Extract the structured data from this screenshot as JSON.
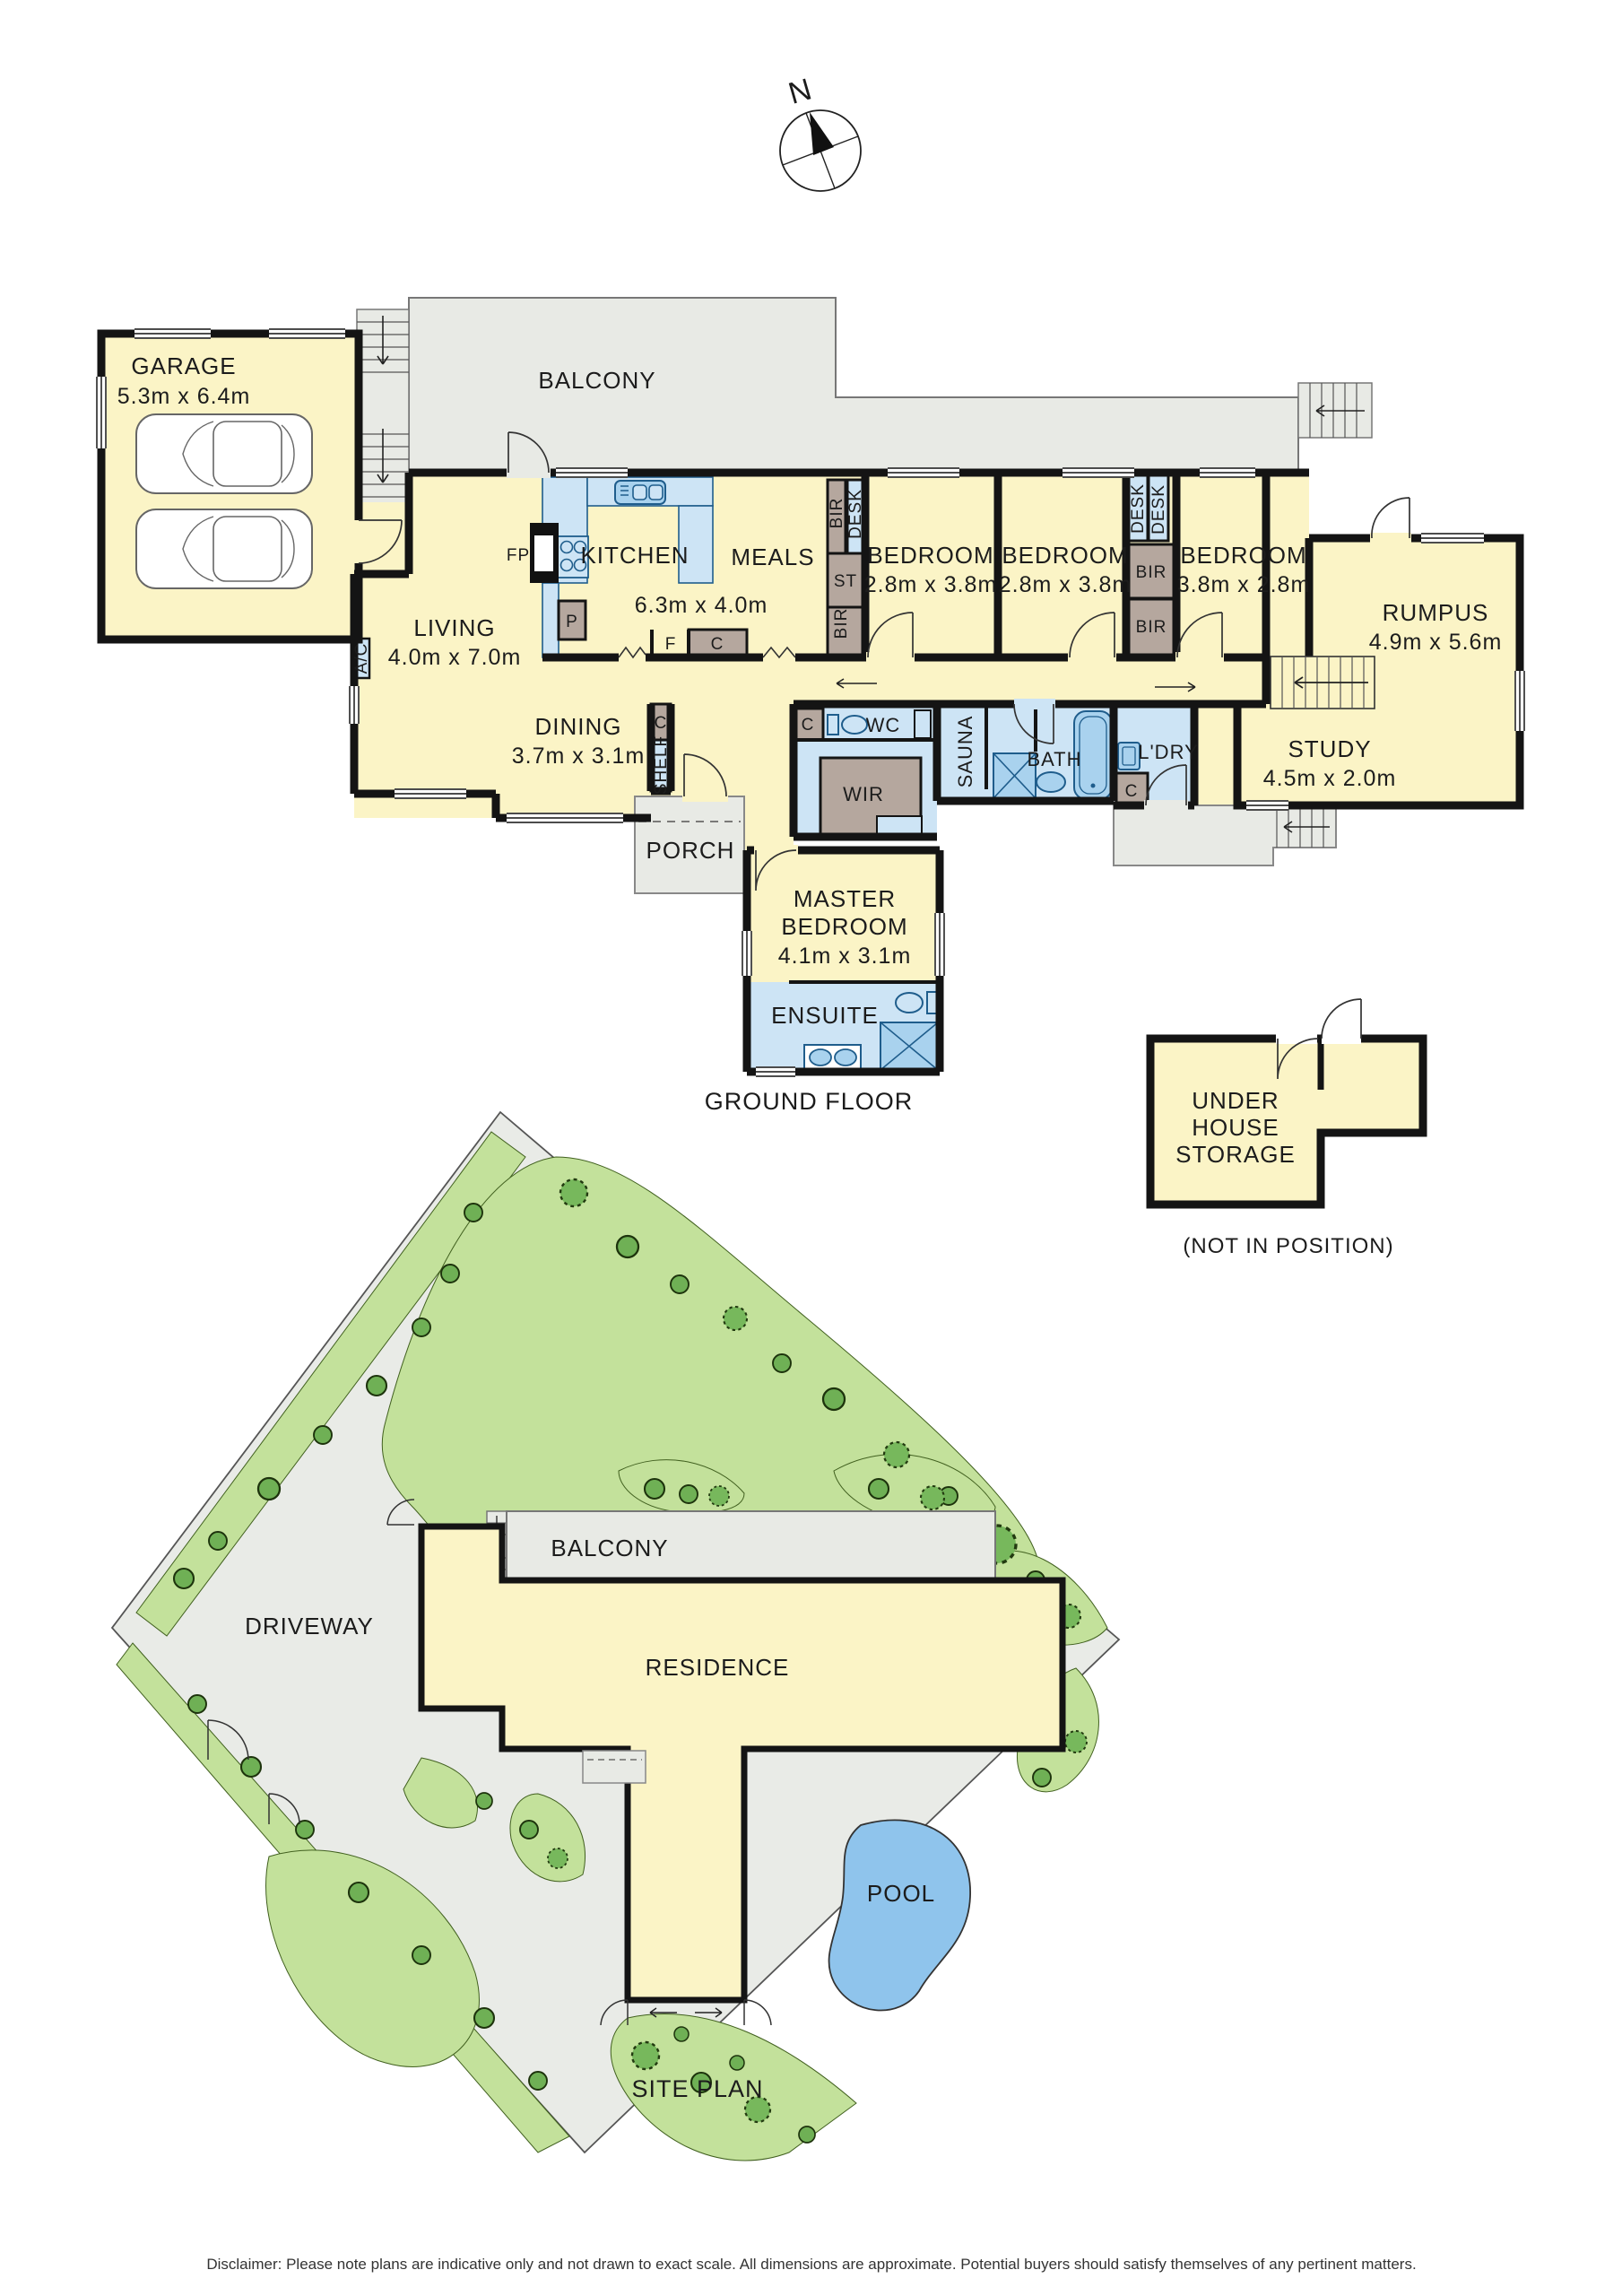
{
  "compass": {
    "north_label": "N"
  },
  "ground_floor": {
    "title": "GROUND FLOOR",
    "rooms": {
      "garage": {
        "name": "GARAGE",
        "dims": "5.3m x 6.4m"
      },
      "balcony": {
        "name": "BALCONY"
      },
      "kitchen": {
        "name": "KITCHEN"
      },
      "meals": {
        "name": "MEALS"
      },
      "kitchen_meals_dims": "6.3m x 4.0m",
      "living": {
        "name": "LIVING",
        "dims": "4.0m x 7.0m"
      },
      "dining": {
        "name": "DINING",
        "dims": "3.7m x 3.1m"
      },
      "bedroom1": {
        "name": "BEDROOM",
        "dims": "2.8m x 3.8m"
      },
      "bedroom2": {
        "name": "BEDROOM",
        "dims": "2.8m x 3.8m"
      },
      "bedroom3": {
        "name": "BEDROOM",
        "dims": "3.8m x 2.8m"
      },
      "rumpus": {
        "name": "RUMPUS",
        "dims": "4.9m x 5.6m"
      },
      "study": {
        "name": "STUDY",
        "dims": "4.5m x 2.0m"
      },
      "master_bedroom": {
        "line1": "MASTER",
        "line2": "BEDROOM",
        "dims": "4.1m x 3.1m"
      },
      "ensuite": {
        "name": "ENSUITE"
      },
      "wir": {
        "name": "WIR"
      },
      "wc": {
        "name": "WC"
      },
      "sauna": {
        "name": "SAUNA"
      },
      "bath": {
        "name": "BATH"
      },
      "laundry": {
        "name": "L'DRY"
      },
      "porch": {
        "name": "PORCH"
      }
    },
    "fixtures": {
      "fireplace": "FP",
      "pantry": "P",
      "fridge": "F",
      "cupboard": "C",
      "store": "ST",
      "robe": "BIR",
      "desk": "DESK",
      "shelf": "SHELF",
      "aircon": "A/C"
    }
  },
  "storage": {
    "line1": "UNDER",
    "line2": "HOUSE",
    "line3": "STORAGE",
    "note": "(NOT IN POSITION)"
  },
  "site_plan": {
    "title": "SITE PLAN",
    "balcony": "BALCONY",
    "residence": "RESIDENCE",
    "driveway": "DRIVEWAY",
    "pool": "POOL"
  },
  "footer": {
    "disclaimer": "Disclaimer: Please note plans are indicative only and not drawn to exact scale. All dimensions are approximate. Potential buyers should satisfy themselves of any pertinent matters."
  },
  "colors": {
    "room_cream": "#FBF4C6",
    "wet_blue": "#CDE4F5",
    "fixture_blue": "#A9D2EE",
    "cabinet_brown": "#B5A79E",
    "deck_grey": "#E8EAE5",
    "lawn_green": "#C3E19B",
    "tree_green": "#77B85C",
    "pool_blue": "#8FC4EC",
    "wall_black": "#141414"
  }
}
